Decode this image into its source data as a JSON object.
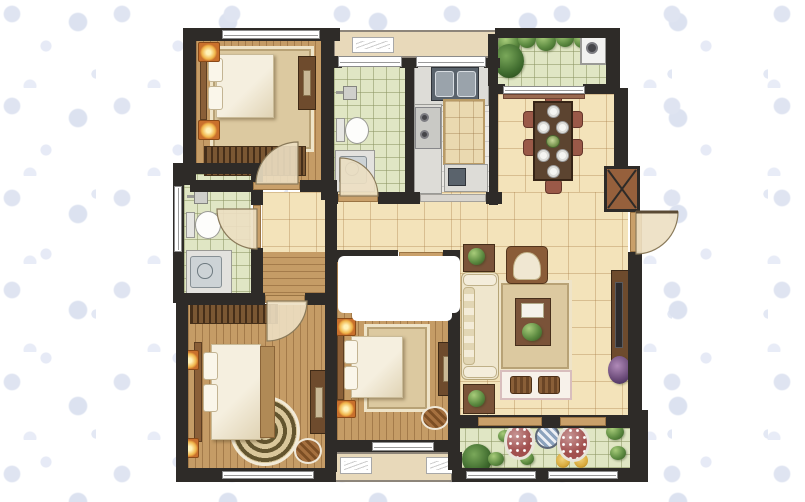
{
  "canvas": {
    "width": 805,
    "height": 502,
    "background": "#ffffff"
  },
  "palette": {
    "watermark": "#dfe4f1",
    "wall": "#2e2b28",
    "wood_floor": "#c59c66",
    "green_tile": "#e0e6c4",
    "beige_tile": "#f3e3ba",
    "pale_tile": "#eceae5",
    "bay_fill": "#e8d9ba",
    "rug_tan": "#dcc9a0",
    "nightstand": "#c9702c",
    "dining_chair": "#9a5948",
    "plant_green": "#5e8c42",
    "flower_yellow": "#d8aa3c",
    "ball_chair": "#a14f4e",
    "shaft_brown": "#96603c",
    "door_leaf_fill": "#ecdfc2"
  },
  "plan": {
    "type": "residential-floor-plan",
    "rooms": [
      {
        "name": "bedroom-top-left",
        "floor": "wood-plank",
        "furniture": [
          "double-bed",
          "nightstand-with-lamp",
          "nightstand-with-lamp",
          "area-rug",
          "wardrobe",
          "dresser"
        ]
      },
      {
        "name": "bathroom-center-top",
        "floor": "green-tile",
        "furniture": [
          "shower-head",
          "toilet",
          "sink-vanity"
        ]
      },
      {
        "name": "kitchen",
        "floor": "pale-tile",
        "furniture": [
          "double-basin-sink",
          "cooktop",
          "island-counter",
          "base-cabinet"
        ]
      },
      {
        "name": "laundry-balcony-top-right",
        "floor": "green-tile",
        "furniture": [
          "washing-machine",
          "potted-plants"
        ]
      },
      {
        "name": "dining-room",
        "floor": "beige-tile",
        "furniture": [
          "dining-table",
          "dining-chairs-x6",
          "place-settings-x6",
          "centerpiece"
        ]
      },
      {
        "name": "living-room",
        "floor": "beige-tile",
        "furniture": [
          "sofa",
          "armchair",
          "coffee-table",
          "area-rug",
          "tv-cabinet",
          "side-table-x2",
          "media-bench",
          "potted-plant"
        ]
      },
      {
        "name": "bedroom-center-bottom",
        "floor": "wood-plank",
        "furniture": [
          "double-bed",
          "nightstand-with-lamp",
          "nightstand-with-lamp",
          "area-rug",
          "dresser",
          "stool"
        ]
      },
      {
        "name": "bathroom-left",
        "floor": "green-tile",
        "furniture": [
          "shower-head",
          "toilet",
          "sink-vanity"
        ]
      },
      {
        "name": "master-bedroom-bottom-left",
        "floor": "wood-plank",
        "furniture": [
          "double-bed",
          "bedside-lamp-x2",
          "wardrobe",
          "round-rug",
          "dresser",
          "stool"
        ]
      },
      {
        "name": "garden-balcony-bottom-right",
        "floor": "green-tile",
        "furniture": [
          "ball-chair-x2",
          "round-side-table",
          "shrubs",
          "yellow-flowers"
        ]
      },
      {
        "name": "hallway",
        "floor": "beige-tile-and-wood"
      },
      {
        "name": "bay-window-top",
        "floor": "bay-platform"
      },
      {
        "name": "bay-window-bottom",
        "floor": "bay-platform"
      },
      {
        "name": "utility-shaft",
        "symbol": "crossed-box"
      },
      {
        "name": "entry",
        "symbol": "door-swing-arc"
      }
    ],
    "doors_with_swing_arcs": 6,
    "dining_place_settings": 6,
    "white_redaction_patch": true
  }
}
